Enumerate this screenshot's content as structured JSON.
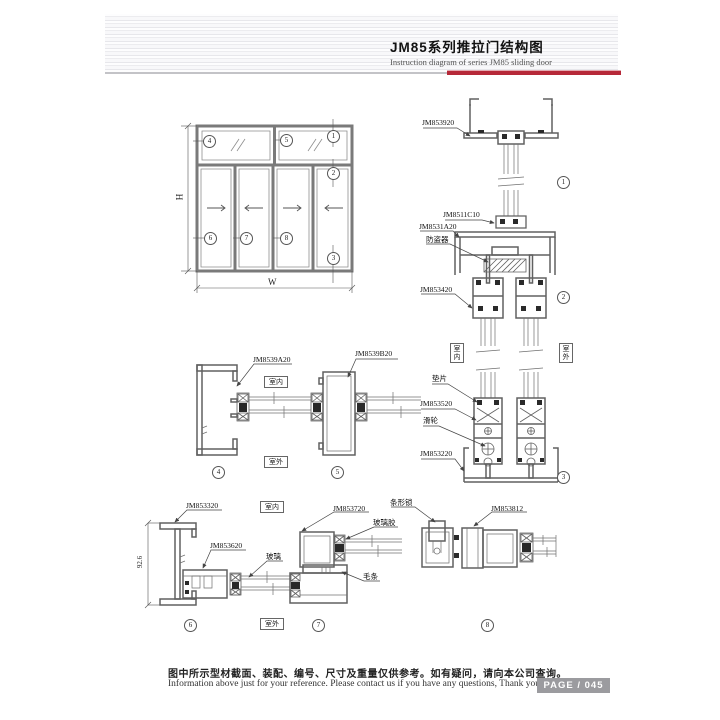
{
  "header": {
    "title_cn": "JM85系列推拉门结构图",
    "title_en": "Instruction diagram of series JM85 sliding door"
  },
  "parts": {
    "jm853920": "JM853920",
    "jm8511c10": "JM8511C10",
    "jm8531a20": "JM8531A20",
    "anti_theft": "防盗器",
    "jm853420": "JM853420",
    "gasket": "垫片",
    "jm853520": "JM853520",
    "roller": "滑轮",
    "jm853220": "JM853220",
    "jm8539a20": "JM8539A20",
    "jm8539b20": "JM8539B20",
    "jm853320": "JM853320",
    "jm853620": "JM853620",
    "glass": "玻璃",
    "jm853720": "JM853720",
    "strip_lock": "条形锁",
    "glass_sealant": "玻璃胶",
    "wool_pile": "毛条",
    "jm853812": "JM853812"
  },
  "env": {
    "indoor": "室内",
    "outdoor": "室外"
  },
  "dims": {
    "height": "H",
    "width": "W",
    "jamb": "92.6"
  },
  "callouts": {
    "n1": "1",
    "n2": "2",
    "n3": "3",
    "n4": "4",
    "n5": "5",
    "n6": "6",
    "n7": "7",
    "n8": "8"
  },
  "footer": {
    "note_cn": "图中所示型材截面、装配、编号、尺寸及重量仅供参考。如有疑问，请向本公司查询。",
    "note_en": "Information above just for your reference. Please contact us if you have any questions, Thank you!",
    "page": "PAGE / 045"
  },
  "colors": {
    "accent_red": "#b62838",
    "line": "#606060",
    "badge_bg": "#9b9b9f"
  }
}
